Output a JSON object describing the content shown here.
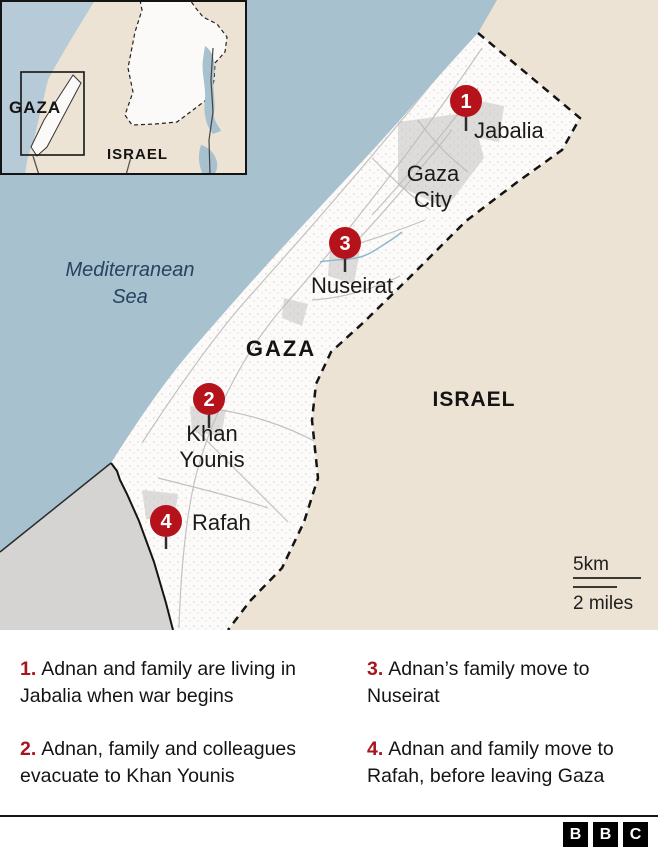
{
  "map": {
    "labels": {
      "mediterranean_line1": "Mediterranean",
      "mediterranean_line2": "Sea",
      "gaza_region": "GAZA",
      "israel": "ISRAEL",
      "gaza_city_line1": "Gaza",
      "gaza_city_line2": "City",
      "jabalia": "Jabalia",
      "nuseirat": "Nuseirat",
      "khan_younis_line1": "Khan",
      "khan_younis_line2": "Younis",
      "rafah": "Rafah"
    },
    "markers": [
      {
        "number": "1",
        "place": "Jabalia"
      },
      {
        "number": "2",
        "place": "Khan Younis"
      },
      {
        "number": "3",
        "place": "Nuseirat"
      },
      {
        "number": "4",
        "place": "Rafah"
      }
    ],
    "scale": {
      "km": "5km",
      "miles": "2 miles"
    },
    "inset": {
      "gaza": "GAZA",
      "israel": "ISRAEL"
    }
  },
  "legend": {
    "items": [
      {
        "number": "1.",
        "text": "Adnan and family are living in Jabalia when war begins"
      },
      {
        "number": "2.",
        "text": "Adnan, family and colleagues evacuate to Khan Younis"
      },
      {
        "number": "3.",
        "text": "Adnan’s family move to Nuseirat"
      },
      {
        "number": "4.",
        "text": "Adnan and family move to Rafah, before leaving Gaza"
      }
    ]
  },
  "footer": {
    "logo_letters": [
      "B",
      "B",
      "C"
    ]
  },
  "colors": {
    "sea": "#a7c1cf",
    "israel_land": "#ece3d4",
    "egypt_land": "#d5d4d2",
    "gaza_strip": "#fcfbf9",
    "marker_red": "#b5121b",
    "legend_number_red": "#a6161f",
    "sea_label_text": "#27435f",
    "border": "#141414"
  }
}
